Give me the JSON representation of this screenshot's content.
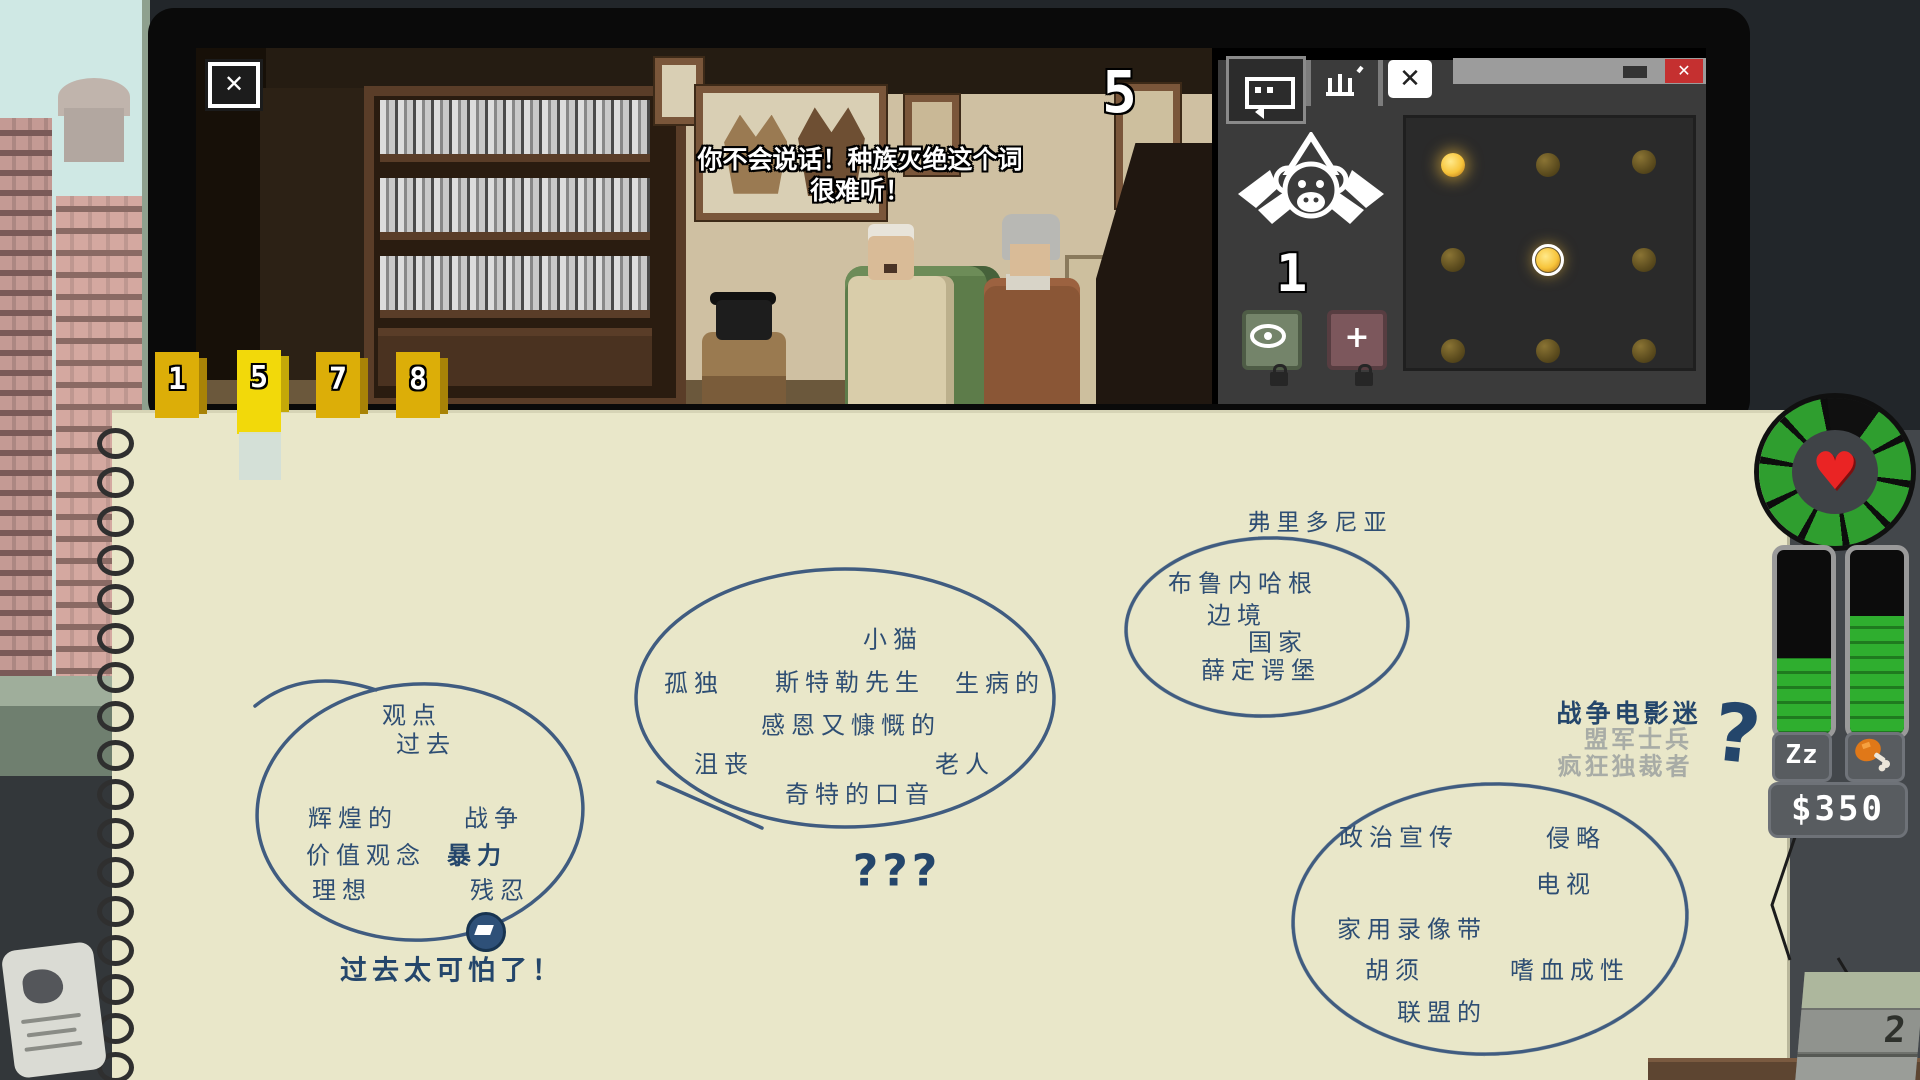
{
  "monitor": {
    "counter": "5",
    "close_button": "✕",
    "dialogue_line1": "你不会说话！种族灭绝这个词",
    "dialogue_line2": "很难听！"
  },
  "panel": {
    "monkey_count": "1",
    "add_button_label": "+",
    "window": {
      "close": "✕"
    },
    "cage_grid": {
      "rows": 3,
      "cols": 3,
      "lit": [
        "0-0",
        "1-1"
      ],
      "selected": "1-1",
      "lit_color": "#f7c43a",
      "dim_color": "#5c4c1e"
    }
  },
  "bookmarks": {
    "tabs": [
      {
        "label": "1",
        "active": false
      },
      {
        "label": "5",
        "active": true
      },
      {
        "label": "7",
        "active": false
      },
      {
        "label": "8",
        "active": false
      }
    ]
  },
  "notebook": {
    "ink_color": "#2e4e73",
    "clusters": {
      "past": {
        "words": [
          "观点",
          "过去",
          "辉煌的",
          "战争",
          "价值观念",
          "暴力",
          "理想",
          "残忍"
        ],
        "note": "过去太可怕了！"
      },
      "person": {
        "words": [
          "小猫",
          "孤独",
          "斯特勒先生",
          "生病的",
          "感恩又慷慨的",
          "沮丧",
          "老人",
          "奇特的口音"
        ],
        "note": "???"
      },
      "place": {
        "title": "弗里多尼亚",
        "words": [
          "布鲁内哈根",
          "边境",
          "国家",
          "薛定谔堡"
        ]
      },
      "media": {
        "words": [
          "政治宣传",
          "侵略",
          "电视",
          "家用录像带",
          "胡须",
          "嗜血成性",
          "联盟的"
        ]
      }
    },
    "guesses": {
      "answer": "战争电影迷",
      "rejected": [
        "盟军士兵",
        "疯狂独裁者"
      ],
      "mark": "?"
    }
  },
  "hud": {
    "money": "$350",
    "sleep_label": "Zz",
    "calendar_day": "2",
    "health_color": "#2f9e2f",
    "heart_icon": "♥"
  }
}
